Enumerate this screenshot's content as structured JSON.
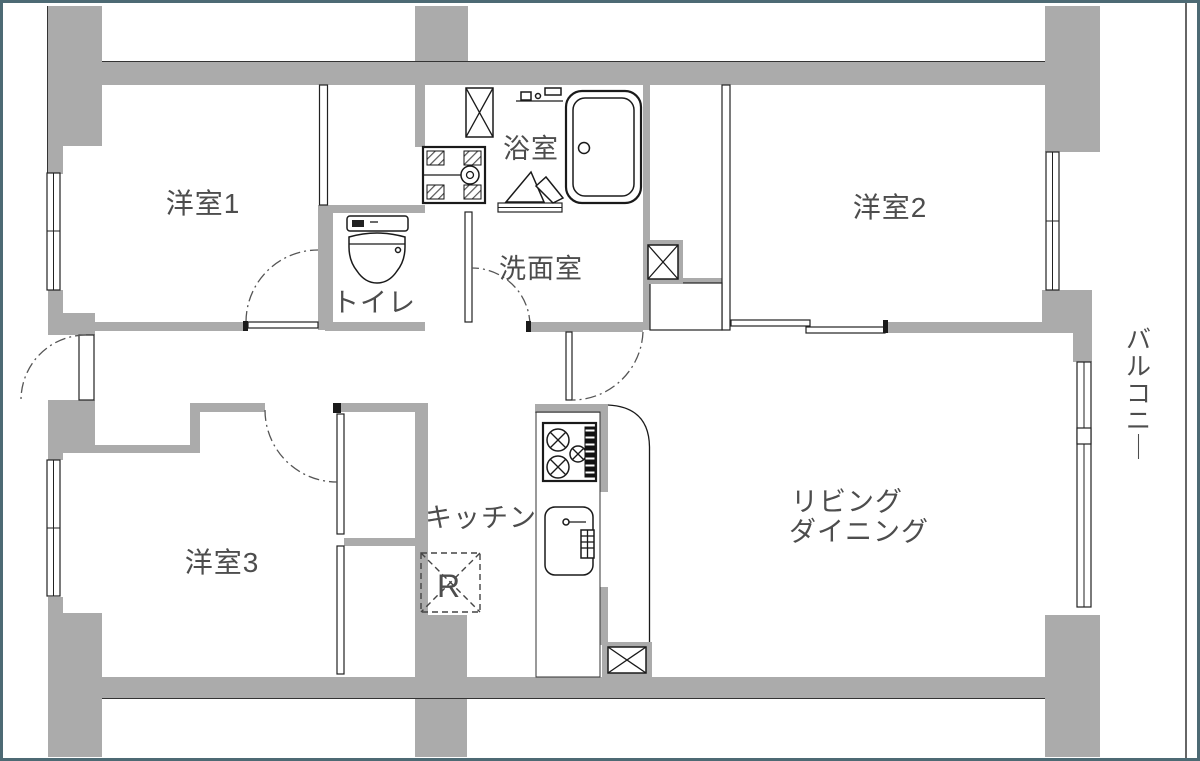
{
  "floorplan": {
    "type": "apartment-floor-plan",
    "rooms": {
      "bedroom1": "洋室1",
      "bedroom2": "洋室2",
      "bedroom3": "洋室3",
      "living_dining": [
        "リビング",
        "ダイニング"
      ],
      "kitchen": "キッチン",
      "bathroom": "浴室",
      "washroom": "洗面室",
      "toilet": "トイレ",
      "balcony": "バルコニー"
    },
    "annotations": {
      "refrigerator_mark": "R"
    },
    "icons": {
      "bathtub": "bathtub-symbol",
      "shower": "shower-mixer-symbol",
      "toilet": "toilet-symbol",
      "stove": "gas-stove-symbol",
      "sink": "kitchen-sink-symbol",
      "washer_pan": "washing-machine-pan-symbol",
      "pipe_space": "pipe-space-x-symbol",
      "door_swing": "door-swing-arc",
      "sliding_door": "sliding-door-panels"
    },
    "colors": {
      "wall_fill": "#ababab",
      "wall_outline": "#3a3a3a",
      "label_text": "#4d4d4d",
      "frame_border": "#4d6a74",
      "swing_arc": "#555555",
      "fixture_outline": "#1a1a1a"
    }
  }
}
